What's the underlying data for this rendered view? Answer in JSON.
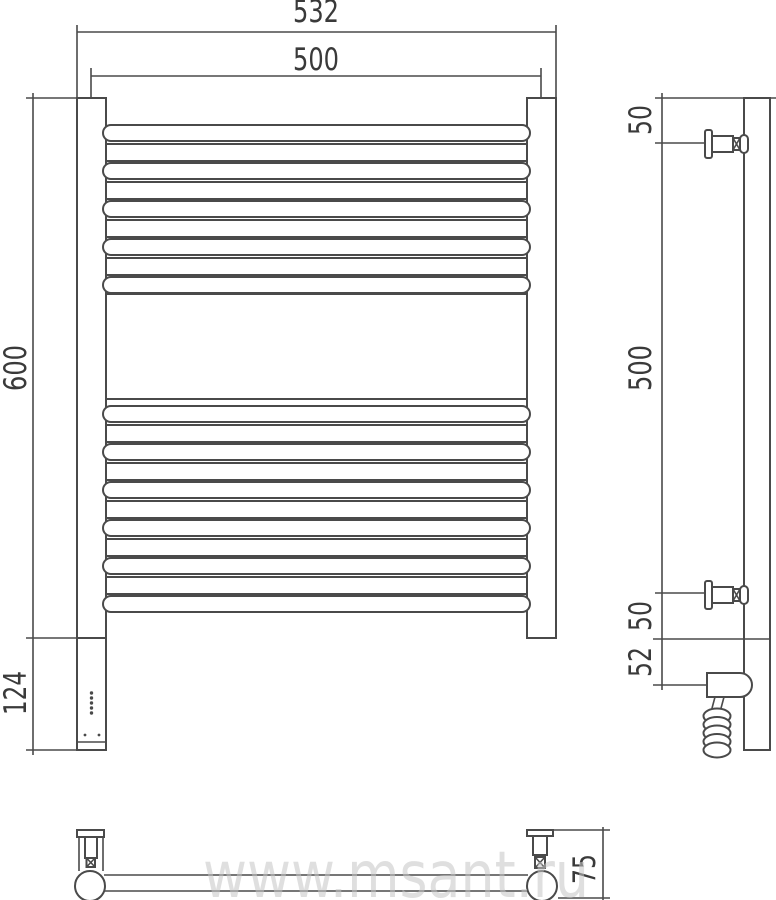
{
  "meta": {
    "type": "technical-drawing",
    "subject": "heated towel rail with electric unit"
  },
  "colors": {
    "line": "#4a4a4a",
    "text": "#3a3a3a",
    "watermark": "#c6c6c6",
    "background": "#ffffff"
  },
  "watermark": "www.msant.ru",
  "front_view": {
    "dim_overall_width": "532",
    "dim_rail_width": "500",
    "dim_height": "600",
    "dim_unit_height": "124",
    "top_rung_count": 5,
    "bottom_rung_count": 6,
    "led_count": 5
  },
  "side_view": {
    "dim_top_bracket": "50",
    "dim_bracket_span": "500",
    "dim_bottom_bracket": "50",
    "dim_unit_axis": "52",
    "cable_coil_count": 5
  },
  "bottom_view": {
    "dim_wall_offset": "75"
  }
}
